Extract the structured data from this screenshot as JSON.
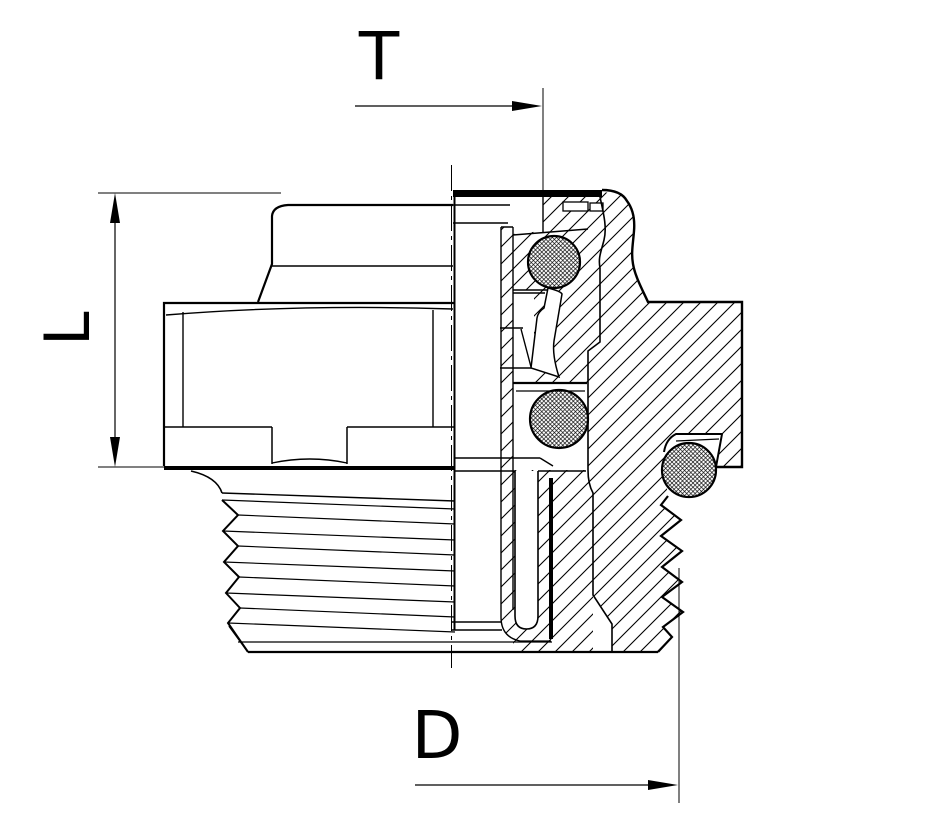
{
  "drawing": {
    "title": "Male threaded push-in plug fitting - half section view",
    "view": "cross-section technical drawing, black line art on white",
    "colors": {
      "line": "#000000",
      "background": "#ffffff"
    },
    "dimensions": {
      "top": {
        "label": "T",
        "orientation": "horizontal",
        "arrow": "right"
      },
      "left": {
        "label": "L",
        "orientation": "vertical",
        "arrow": "both"
      },
      "bottom": {
        "label": "D",
        "orientation": "horizontal",
        "arrow": "right"
      }
    },
    "features": {
      "o_rings": 3,
      "thread_teeth_per_side": 5,
      "hatched_section": true,
      "centerline": "vertical dash-dot"
    }
  }
}
